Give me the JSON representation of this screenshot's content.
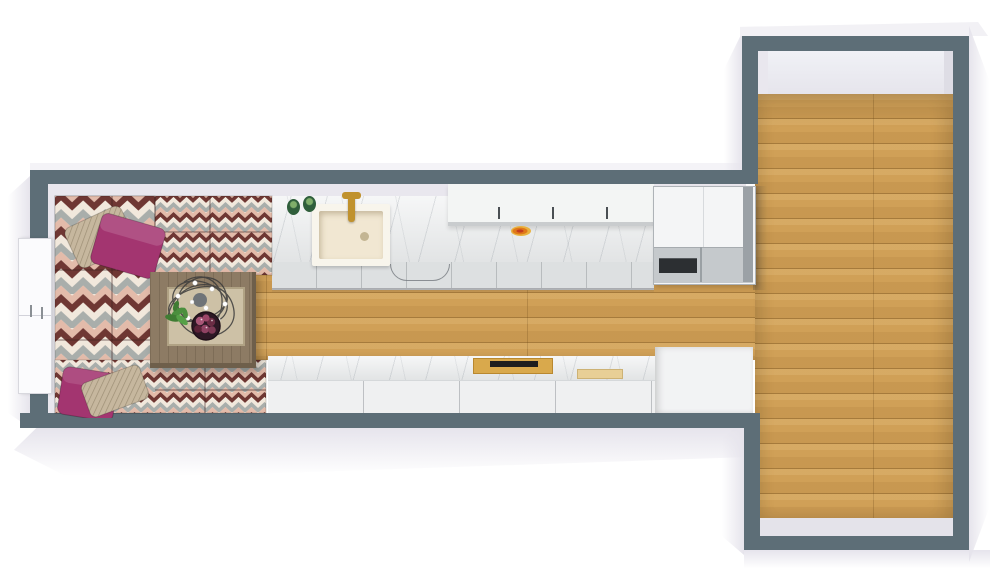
{
  "scene": {
    "description": "3D top-down floor plan render of a T-shaped studio apartment",
    "left_wing": {
      "label": "living area and galley kitchen",
      "objects": [
        "corner sofa with chevron zigzag upholstery",
        "two magenta throw pillows",
        "two tan woven throw pillows",
        "wooden coffee table with tray",
        "black wire sculpture with white flowers",
        "green potted plant",
        "bowl of burgundy decorative balls",
        "white double door on left wall",
        "marble kitchen countertop",
        "white farmhouse sink",
        "gold faucet",
        "two green jars",
        "white upper wall cabinets",
        "orange fruit dish",
        "stainless refrigerator",
        "lower marble counter run",
        "gold cutting board with dark inlay",
        "light wood cutting board",
        "tall white cabinet block"
      ]
    },
    "right_room": {
      "label": "empty room with oak plank floor",
      "objects": []
    }
  },
  "colors": {
    "background": "#ffffff",
    "wall": "#5d6e77",
    "wall_inner_face": "#e9e7ee",
    "exterior_face": "#e6e4ec",
    "floor_wood": "#d0a057",
    "marble_base": "#ebedee",
    "cabinet_front": "#dde0e1",
    "cabinet_seam": "#b8bcbe",
    "upper_cabinet": "#f3f5f4",
    "fridge_top": "#f4f5f6",
    "fridge_door": "#c5c9cc",
    "fridge_recess": "#2c2f32",
    "fridge_side": "#9ba1a6",
    "sink_outer": "#f8f5ec",
    "sink_basin": "#f1e7d2",
    "faucet_gold": "#c0922e",
    "jar_green": "#2f5e3b",
    "fruit_orange": "#e07818",
    "chevron_maroon": "#6f3733",
    "chevron_cream": "#f1e8dc",
    "chevron_gray": "#a9aeab",
    "chevron_pink": "#e3bbaa",
    "pillow_magenta": "#a33570",
    "pillow_tan": "#c6b79e",
    "table_wood": "#8d7b64",
    "table_wood_dark": "#6e5f4b",
    "table_tray": "#cdc1a6",
    "plant_green": "#4b8f3e",
    "bowl_dark": "#2e1825",
    "ball_pink": "#a85677",
    "ball_maroon": "#6b2c44",
    "board_gold": "#d9a94c",
    "board_light": "#e8cf96",
    "board_black": "#1e1e1e",
    "door_white": "#fbfbfd"
  }
}
